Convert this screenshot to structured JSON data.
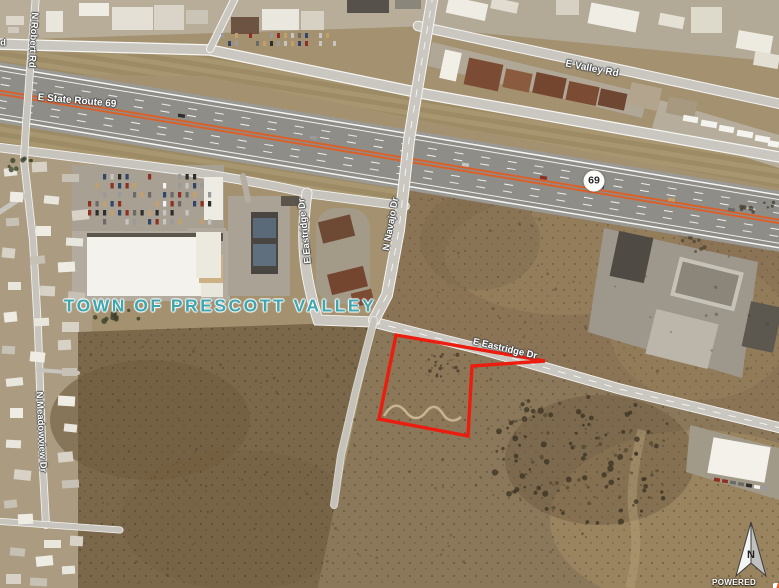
{
  "map": {
    "town_label": {
      "text": "TOWN OF PRESCOTT VALLEY",
      "x": 220,
      "y": 306,
      "font_size": 17.5,
      "color": "#3fa6b0"
    },
    "road_labels": [
      {
        "text": "N Robert Rd",
        "x": 33,
        "y": 40,
        "rot": 93,
        "fs": 9.5
      },
      {
        "text": "d",
        "x": 3,
        "y": 43,
        "rot": 0,
        "fs": 9.5
      },
      {
        "text": "E State Route 69",
        "x": 77,
        "y": 101,
        "rot": 5,
        "fs": 10
      },
      {
        "text": "E Valley Rd",
        "x": 592,
        "y": 69,
        "rot": 11,
        "fs": 10
      },
      {
        "text": "N Navajo Dr",
        "x": 391,
        "y": 224,
        "rot": -80,
        "fs": 9.5
      },
      {
        "text": "E Eastridge Dr",
        "x": 305,
        "y": 231,
        "rot": -96,
        "fs": 9.5
      },
      {
        "text": "E Eastridge Dr",
        "x": 505,
        "y": 349,
        "rot": 13,
        "fs": 9.5
      },
      {
        "text": "N Meadowview Dr",
        "x": 41,
        "y": 432,
        "rot": 87,
        "fs": 9.5
      }
    ],
    "route_shield": {
      "number": "69",
      "x": 594,
      "y": 181
    },
    "compass": {
      "letter": "N"
    },
    "attribution": {
      "text": "POWERED BY"
    },
    "parcel": {
      "outline_color": "#ec1c0f",
      "points": "396,335 545,361 472,366 468,436 379,419"
    },
    "colors": {
      "highway_median": "#dd5f28",
      "road_fill": "#c9c7c0",
      "field_dark": "#7b674a",
      "field_light": "#8b7455",
      "developed": "#b7ad99"
    }
  }
}
